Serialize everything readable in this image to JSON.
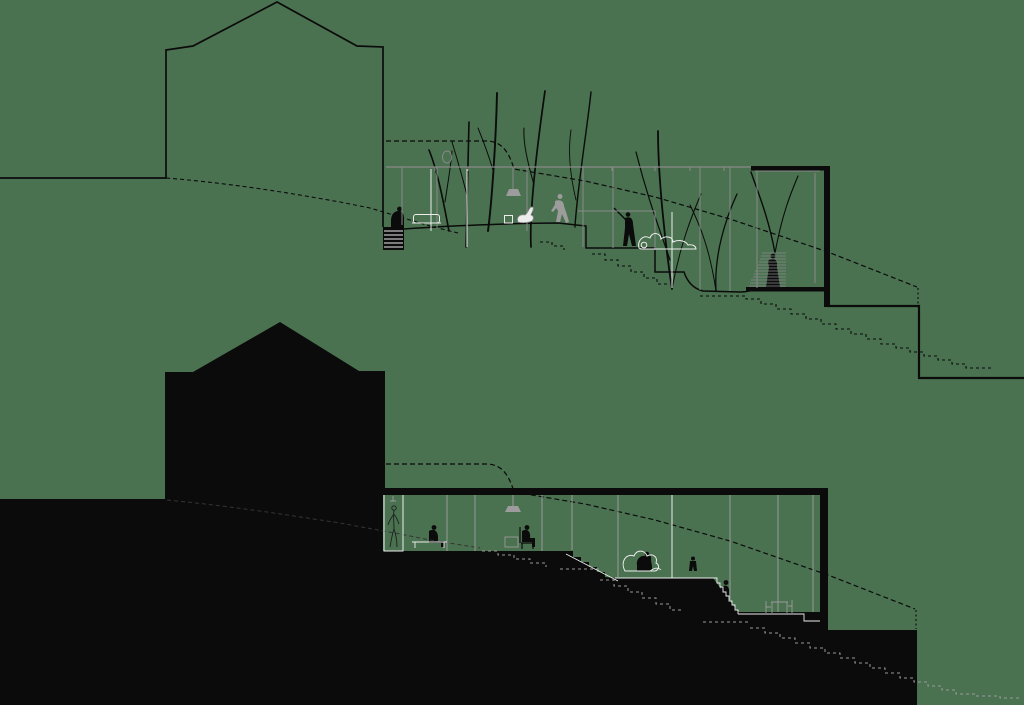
{
  "canvas": {
    "width": 1024,
    "height": 705
  },
  "colors": {
    "background": "#4a7250",
    "ink": "#0b0b0b",
    "frame_gray": "#8a8a8a",
    "dash_gray": "#9a9a9a",
    "figure_gray": "#9c9c9c",
    "white": "#ececec",
    "dash_dark": "#343434",
    "outline_dark": "#1f1f1f"
  },
  "sections": [
    {
      "id": "upper-section",
      "style": "outline line drawing",
      "elements": [
        "gabled house silhouette",
        "ground line",
        "dashed original-grade line",
        "dashed terraced steps",
        "entry stair with seated figure",
        "glazed garden room with flat roof",
        "trees growing through roof",
        "oval tree crown",
        "sofa outline",
        "side table",
        "pendant lamp",
        "goose",
        "walking figure",
        "gardening figure with raised arm",
        "lounger outline",
        "sunken planter",
        "stair pavilion with descending figure",
        "lower terrace retaining wall"
      ]
    },
    {
      "id": "lower-section",
      "style": "solid black poche",
      "elements": [
        "gabled house silhouette filled",
        "hillside mass filled",
        "roof slab",
        "entry vestibule with standing outline figure",
        "bench with seated figure",
        "pendant lamp",
        "chair with seated figure",
        "side table",
        "stair with white treads",
        "figure descending stair",
        "planting bed outline",
        "crouching figure",
        "child figure",
        "dining table with chairs",
        "stepped terrain dashes",
        "retaining wall edge"
      ]
    }
  ]
}
